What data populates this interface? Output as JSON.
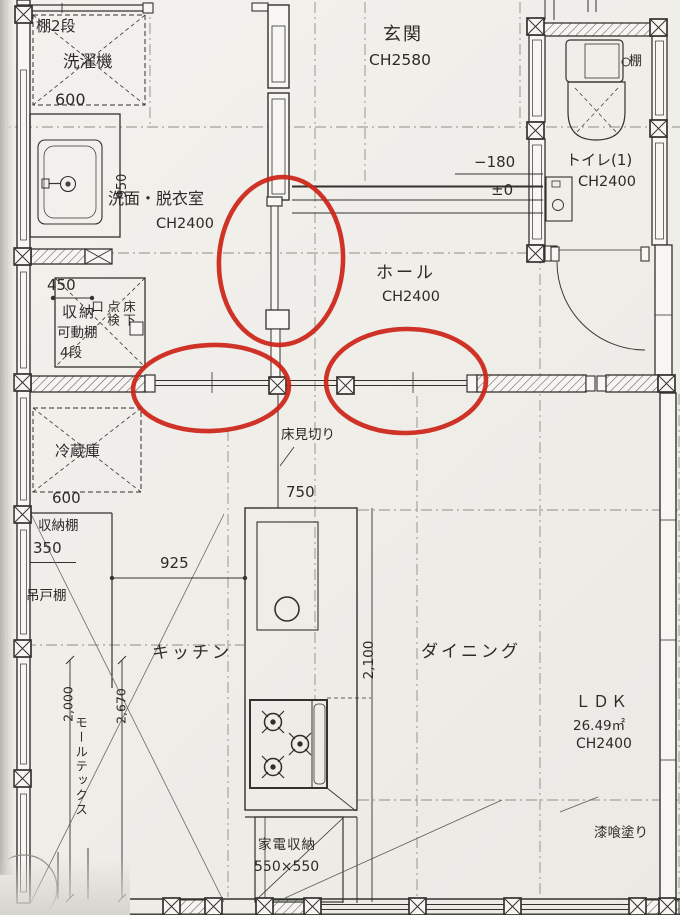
{
  "annotation_color": "#cd2418",
  "paper_color": "#f0eeea",
  "rooms": {
    "entrance": {
      "name": "玄関",
      "ceiling": "CH2580"
    },
    "toilet": {
      "name": "トイレ(1)",
      "ceiling": "CH2400",
      "shelf": "棚"
    },
    "washroom": {
      "name": "洗面・脱衣室",
      "ceiling": "CH2400"
    },
    "hall": {
      "name": "ホール",
      "ceiling": "CH2400"
    },
    "kitchen": {
      "name": "キッチン"
    },
    "dining": {
      "name": "ダイニング"
    },
    "ldk": {
      "name": "ＬＤＫ",
      "area": "26.49㎡",
      "ceiling": "CH2400"
    }
  },
  "labels": {
    "shelf_two_tier": "棚2段",
    "washing_machine": "洗濯機",
    "storage_closet": "収納",
    "movable_shelf": "可動棚",
    "four_tiers": "4段",
    "underfloor_hatch": "床下点検口",
    "refrigerator": "冷蔵庫",
    "storage_shelf": "収納棚",
    "hanging_cupboard": "吊戸棚",
    "mortex_finish": "モールテックス",
    "floor_divider": "床見切り",
    "appliance_storage": "家電収納",
    "appliance_storage_size": "550×550",
    "plaster_finish": "漆喰塗り"
  },
  "dimensions": {
    "washer_width": "600",
    "vanity_depth": "950",
    "closet_depth": "450",
    "fridge_width": "600",
    "shelf_depth": "350",
    "counter_gap": "925",
    "island_width": "750",
    "island_length": "2,100",
    "kitchen_len_a": "2,000",
    "kitchen_len_b": "2,670",
    "entrance_level": "−180",
    "floor_level": "±0"
  }
}
